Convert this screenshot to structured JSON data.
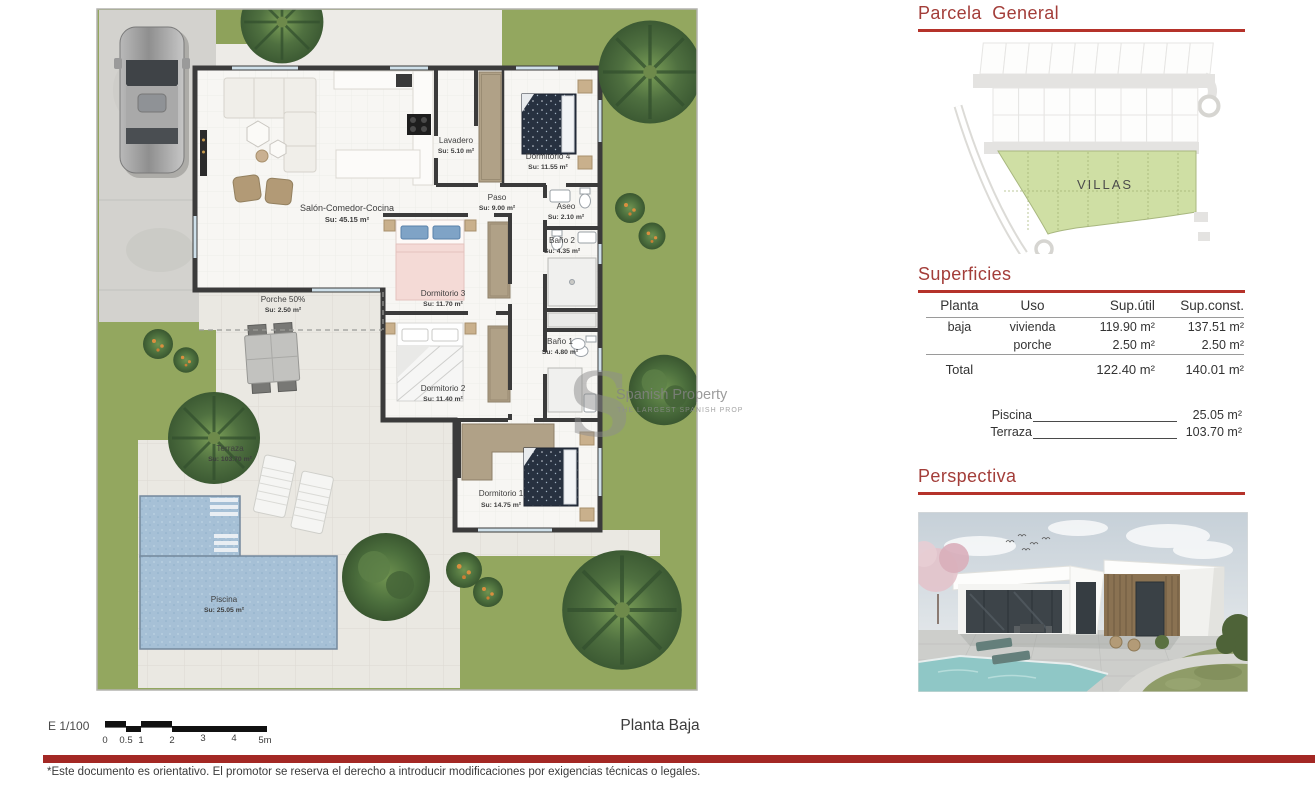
{
  "colors": {
    "accent_red_text": "#a33d39",
    "accent_red_line": "#b5322a",
    "footer_bar_red": "#a32824",
    "grass_green": "#93a75f",
    "parcel_green": "#cfdfa4",
    "pool_blue": "#a6c0d6",
    "wall_dark": "#3b3b3b",
    "wardrobe_tan": "#b0a187"
  },
  "floorplan": {
    "title": "Planta  Baja",
    "scale": {
      "label": "E  1/100",
      "ticks": [
        "0",
        "0.5",
        "1",
        "2",
        "3",
        "4",
        "5m"
      ]
    },
    "rooms": [
      {
        "name": "Salón-Comedor-Cocina",
        "area": "Su: 45.15 m²"
      },
      {
        "name": "Lavadero",
        "area": "Su: 5.10 m²"
      },
      {
        "name": "Paso",
        "area": "Su: 9.00 m²"
      },
      {
        "name": "Dormitorio 4",
        "area": "Su: 11.55 m²"
      },
      {
        "name": "Aseo",
        "area": "Su: 2.10 m²"
      },
      {
        "name": "Baño 2",
        "area": "Su: 4.35 m²"
      },
      {
        "name": "Dormitorio 3",
        "area": "Su: 11.70 m²"
      },
      {
        "name": "Dormitorio 2",
        "area": "Su: 11.40 m²"
      },
      {
        "name": "Baño 1",
        "area": "Su: 4.80 m²"
      },
      {
        "name": "Dormitorio 1",
        "area": "Su: 14.75 m²"
      },
      {
        "name": "Porche 50%",
        "area": "Su: 2.50 m²"
      },
      {
        "name": "Terraza",
        "area": "Su: 103.70 m²"
      },
      {
        "name": "Piscina",
        "area": "Su: 25.05 m²"
      }
    ],
    "watermark": {
      "logo": "S",
      "line1": "Spanish Property",
      "line2": "THE LARGEST SPANISH PROP"
    }
  },
  "sidebar": {
    "parcela": {
      "title": "Parcela  General",
      "zone_label": "VILLAS"
    },
    "superficies": {
      "title": "Superficies",
      "headers": {
        "planta": "Planta",
        "uso": "Uso",
        "util": "Sup.útil",
        "const": "Sup.const."
      },
      "rows": [
        {
          "planta": "baja",
          "uso": "vivienda",
          "util": "119.90 m²",
          "const": "137.51 m²"
        },
        {
          "planta": "",
          "uso": "porche",
          "util": "2.50 m²",
          "const": "2.50 m²"
        }
      ],
      "total": {
        "label": "Total",
        "util": "122.40 m²",
        "const": "140.01 m²"
      },
      "extras": [
        {
          "label": "Piscina",
          "value": "25.05 m²"
        },
        {
          "label": "Terraza",
          "value": "103.70 m²"
        }
      ]
    },
    "perspectiva": {
      "title": "Perspectiva"
    }
  },
  "footer": {
    "disclaimer": "*Este documento es orientativo. El promotor se reserva el derecho a introducir modificaciones por exigencias técnicas o legales."
  }
}
